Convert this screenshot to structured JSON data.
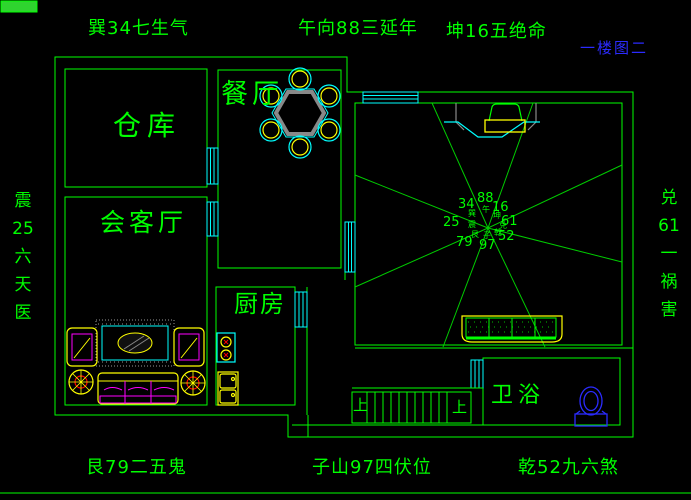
{
  "title": {
    "text": "一楼图二"
  },
  "perimeter_labels": {
    "top_left": "巽34七生气",
    "top_center": "午向88三延年",
    "top_right": "坤16五绝命",
    "left_vertical": [
      "震",
      "25",
      "六",
      "天",
      "医"
    ],
    "right_vertical": [
      "兑",
      "61",
      "一",
      "祸",
      "害"
    ],
    "bottom_left": "艮79二五鬼",
    "bottom_center": "子山97四伏位",
    "bottom_right": "乾52九六煞"
  },
  "rooms": {
    "storage": "仓库",
    "dining": "餐厅",
    "living": "会客厅",
    "kitchen": "厨房",
    "bathroom": "卫浴"
  },
  "stairs": {
    "up_left": "上",
    "up_right": "上"
  },
  "center_chart": {
    "items": [
      {
        "num": "34",
        "char": "巽"
      },
      {
        "num": "88",
        "char": "午"
      },
      {
        "num": "16",
        "char": "坤"
      },
      {
        "num": "25",
        "char": "震"
      },
      {
        "num": "61",
        "char": "兑"
      },
      {
        "num": "79",
        "char": "艮"
      },
      {
        "num": "97",
        "char": "子"
      },
      {
        "num": "52",
        "char": "乾"
      }
    ]
  },
  "colors": {
    "line_green": "#00ff00",
    "cyan": "#00ffff",
    "yellow": "#ffff00",
    "magenta": "#ff00ff",
    "gray": "#888888",
    "blue": "#2b2bff",
    "red": "#ff0000",
    "background": "#000000"
  }
}
